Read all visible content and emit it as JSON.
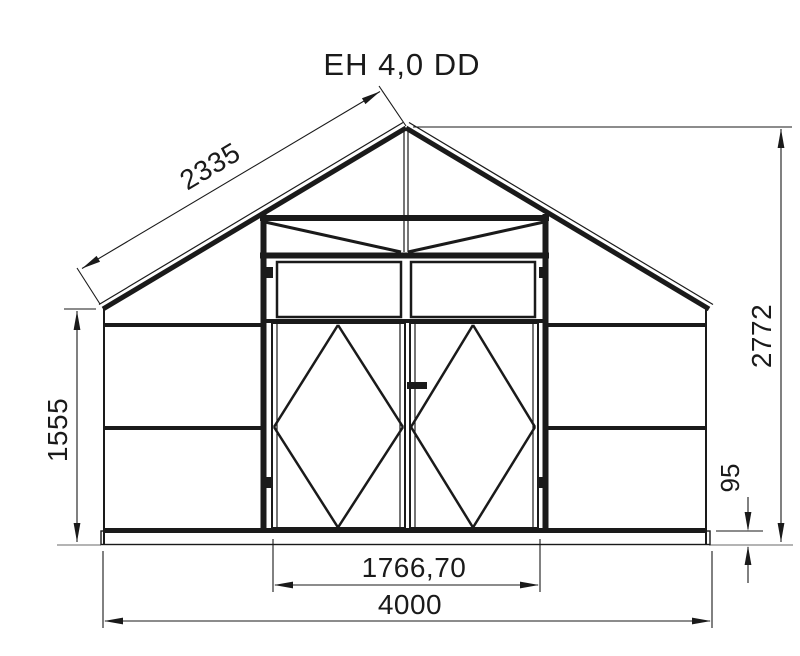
{
  "title": "EH 4,0 DD",
  "diagram_type": "technical-elevation-drawing",
  "subject": "greenhouse front elevation with double doors",
  "colors": {
    "line": "#1a1a1a",
    "ground_extension": "#9b9b9b",
    "background": "#ffffff"
  },
  "dimensions": {
    "roof_slope": {
      "label": "2335"
    },
    "left_wall_height": {
      "label": "1555"
    },
    "total_height": {
      "label": "2772"
    },
    "base_height": {
      "label": "95"
    },
    "door_opening_width": {
      "label": "1766,70"
    },
    "total_width": {
      "label": "4000"
    }
  },
  "geometry": {
    "canvas": {
      "width": 800,
      "height": 656
    },
    "arrow": {
      "length": 19,
      "half_width": 3.4
    },
    "segments": [
      [
        "roof-left-outer-line",
        403,
        122.5,
        99,
        304.5,
        1.2,
        "line"
      ],
      [
        "roof-left-rafter",
        406,
        128,
        103,
        309,
        5,
        "line"
      ],
      [
        "roof-right-outer-line",
        409,
        122.5,
        713,
        304.5,
        1.2,
        "line"
      ],
      [
        "roof-right-rafter",
        406,
        128,
        709,
        309,
        5,
        "line"
      ],
      [
        "wall-left-post",
        104,
        308,
        104,
        544,
        2,
        "line"
      ],
      [
        "wall-right-post",
        706,
        308,
        706,
        544,
        2,
        "line"
      ],
      [
        "girt-left-top",
        105,
        325,
        261,
        325,
        4,
        "line"
      ],
      [
        "girt-left-mid",
        105,
        428,
        261,
        428,
        4,
        "line"
      ],
      [
        "girt-right-top",
        548,
        325,
        705,
        325,
        4,
        "line"
      ],
      [
        "girt-right-mid",
        548,
        428,
        705,
        428,
        4,
        "line"
      ],
      [
        "bottom-rail",
        105,
        530.5,
        705,
        530.5,
        5,
        "line"
      ],
      [
        "door-frame-post-left",
        263.5,
        214,
        263.5,
        531,
        6,
        "line"
      ],
      [
        "door-frame-post-right",
        545.5,
        214,
        545.5,
        531,
        6,
        "line"
      ],
      [
        "gable-bottom-chord",
        260,
        218,
        549,
        218,
        6,
        "line"
      ],
      [
        "door-header-bar",
        260,
        255.5,
        549,
        255.5,
        6,
        "line"
      ],
      [
        "gable-diagonal-left",
        265,
        222,
        401,
        252,
        3,
        "line"
      ],
      [
        "gable-diagonal-right",
        544,
        222,
        408,
        252,
        3,
        "line"
      ],
      [
        "gable-center-mullion-a",
        404,
        131,
        404,
        252,
        1.2,
        "line"
      ],
      [
        "gable-center-mullion-b",
        408,
        131,
        408,
        252,
        1.2,
        "line"
      ],
      [
        "transom-sill-bar",
        263,
        321,
        546,
        321,
        4,
        "line"
      ],
      [
        "door-left-inner-stile-a",
        277,
        324,
        277,
        527,
        1.2,
        "line"
      ],
      [
        "door-left-inner-stile-b",
        400,
        324,
        400,
        527,
        1.2,
        "line"
      ],
      [
        "door-right-inner-stile-a",
        415,
        324,
        415,
        527,
        1.2,
        "line"
      ],
      [
        "door-right-inner-stile-b",
        533,
        324,
        533,
        527,
        1.2,
        "line"
      ],
      [
        "diamond-brace-left-tl",
        338,
        325,
        274,
        427,
        2.5,
        "line"
      ],
      [
        "diamond-brace-left-bl",
        274,
        427,
        338,
        527.5,
        2.5,
        "line"
      ],
      [
        "diamond-brace-left-br",
        338,
        527.5,
        403,
        427,
        2.5,
        "line"
      ],
      [
        "diamond-brace-left-tr",
        403,
        427,
        338,
        325,
        2.5,
        "line"
      ],
      [
        "diamond-brace-right-tl",
        473,
        325,
        411,
        427,
        2.5,
        "line"
      ],
      [
        "diamond-brace-right-bl",
        411,
        427,
        473,
        527.5,
        2.5,
        "line"
      ],
      [
        "diamond-brace-right-br",
        473,
        527.5,
        535,
        427,
        2.5,
        "line"
      ],
      [
        "diamond-brace-right-tr",
        535,
        427,
        473,
        325,
        2.5,
        "line"
      ],
      [
        "dim-roof-ext-apex",
        406,
        126,
        379,
        86,
        1.1,
        "line"
      ],
      [
        "dim-roof-ext-eave",
        100,
        304,
        77,
        268,
        1.1,
        "line"
      ],
      [
        "dim-roof-line",
        82,
        268.5,
        380,
        91.5,
        1.1,
        "line"
      ],
      [
        "dim-wall-ext-top",
        96,
        309,
        64,
        309,
        1.1,
        "line"
      ],
      [
        "dim-wall-line",
        77,
        311,
        77,
        542,
        1.1,
        "line"
      ],
      [
        "dim-height-ext-top",
        413,
        127,
        792,
        127,
        1.1,
        "line"
      ],
      [
        "dim-height-line",
        781,
        129,
        781,
        542,
        1.1,
        "line"
      ],
      [
        "dim-base-ext",
        716,
        531,
        763,
        531,
        1.1,
        "line"
      ],
      [
        "dim-base-line-upper",
        748,
        497,
        748,
        529,
        1.1,
        "line"
      ],
      [
        "dim-base-line-lower",
        748,
        547,
        748,
        583,
        1.1,
        "line"
      ],
      [
        "dim-door-ext-left",
        273,
        539,
        273,
        592,
        1.1,
        "line"
      ],
      [
        "dim-door-ext-right",
        540,
        539,
        540,
        592,
        1.1,
        "line"
      ],
      [
        "dim-door-line",
        275,
        585,
        538,
        585,
        1.1,
        "line"
      ],
      [
        "dim-width-ext-left",
        103,
        551,
        103,
        628,
        1.1,
        "line"
      ],
      [
        "dim-width-ext-right",
        712,
        551,
        712,
        628,
        1.1,
        "line"
      ],
      [
        "dim-width-line",
        105,
        621,
        710,
        621,
        1.1,
        "line"
      ],
      [
        "ground-ext-left",
        57,
        545,
        101,
        545,
        1.4,
        "ground_extension"
      ],
      [
        "ground-ext-right",
        709,
        545,
        793,
        545,
        1.4,
        "ground_extension"
      ]
    ],
    "rects": [
      [
        "base-plate",
        101,
        531,
        609,
        13.5,
        1.4
      ],
      [
        "transom-window-left",
        277,
        262,
        124,
        55,
        2.5
      ],
      [
        "transom-window-right",
        411,
        262,
        124,
        55,
        2.5
      ],
      [
        "door-leaf-left",
        272,
        323,
        133,
        205,
        2
      ],
      [
        "door-leaf-right",
        410,
        323,
        128,
        205,
        2
      ],
      [
        "door-handle",
        407,
        382,
        20,
        7,
        0
      ],
      [
        "hinge-left-top",
        266,
        267,
        7,
        11,
        0
      ],
      [
        "hinge-left-bottom",
        266,
        477,
        7,
        11,
        0
      ],
      [
        "hinge-right-top",
        539,
        267,
        7,
        11,
        0
      ],
      [
        "hinge-right-bottom",
        539,
        477,
        7,
        11,
        0
      ]
    ],
    "arrows": [
      [
        "arrow-roof-upper",
        380,
        91.5,
        -30.8
      ],
      [
        "arrow-roof-lower",
        82,
        268.5,
        149.2
      ],
      [
        "arrow-wall-top",
        77,
        311,
        -90
      ],
      [
        "arrow-wall-bottom",
        77,
        542,
        90
      ],
      [
        "arrow-height-top",
        781,
        129,
        -90
      ],
      [
        "arrow-height-bottom",
        781,
        542,
        90
      ],
      [
        "arrow-base-upper",
        748,
        531,
        90
      ],
      [
        "arrow-base-lower",
        748,
        546,
        -90
      ],
      [
        "arrow-door-left",
        274,
        585,
        180
      ],
      [
        "arrow-door-right",
        539,
        585,
        0
      ],
      [
        "arrow-width-left",
        104,
        621,
        180
      ],
      [
        "arrow-width-right",
        711,
        621,
        0
      ]
    ]
  }
}
